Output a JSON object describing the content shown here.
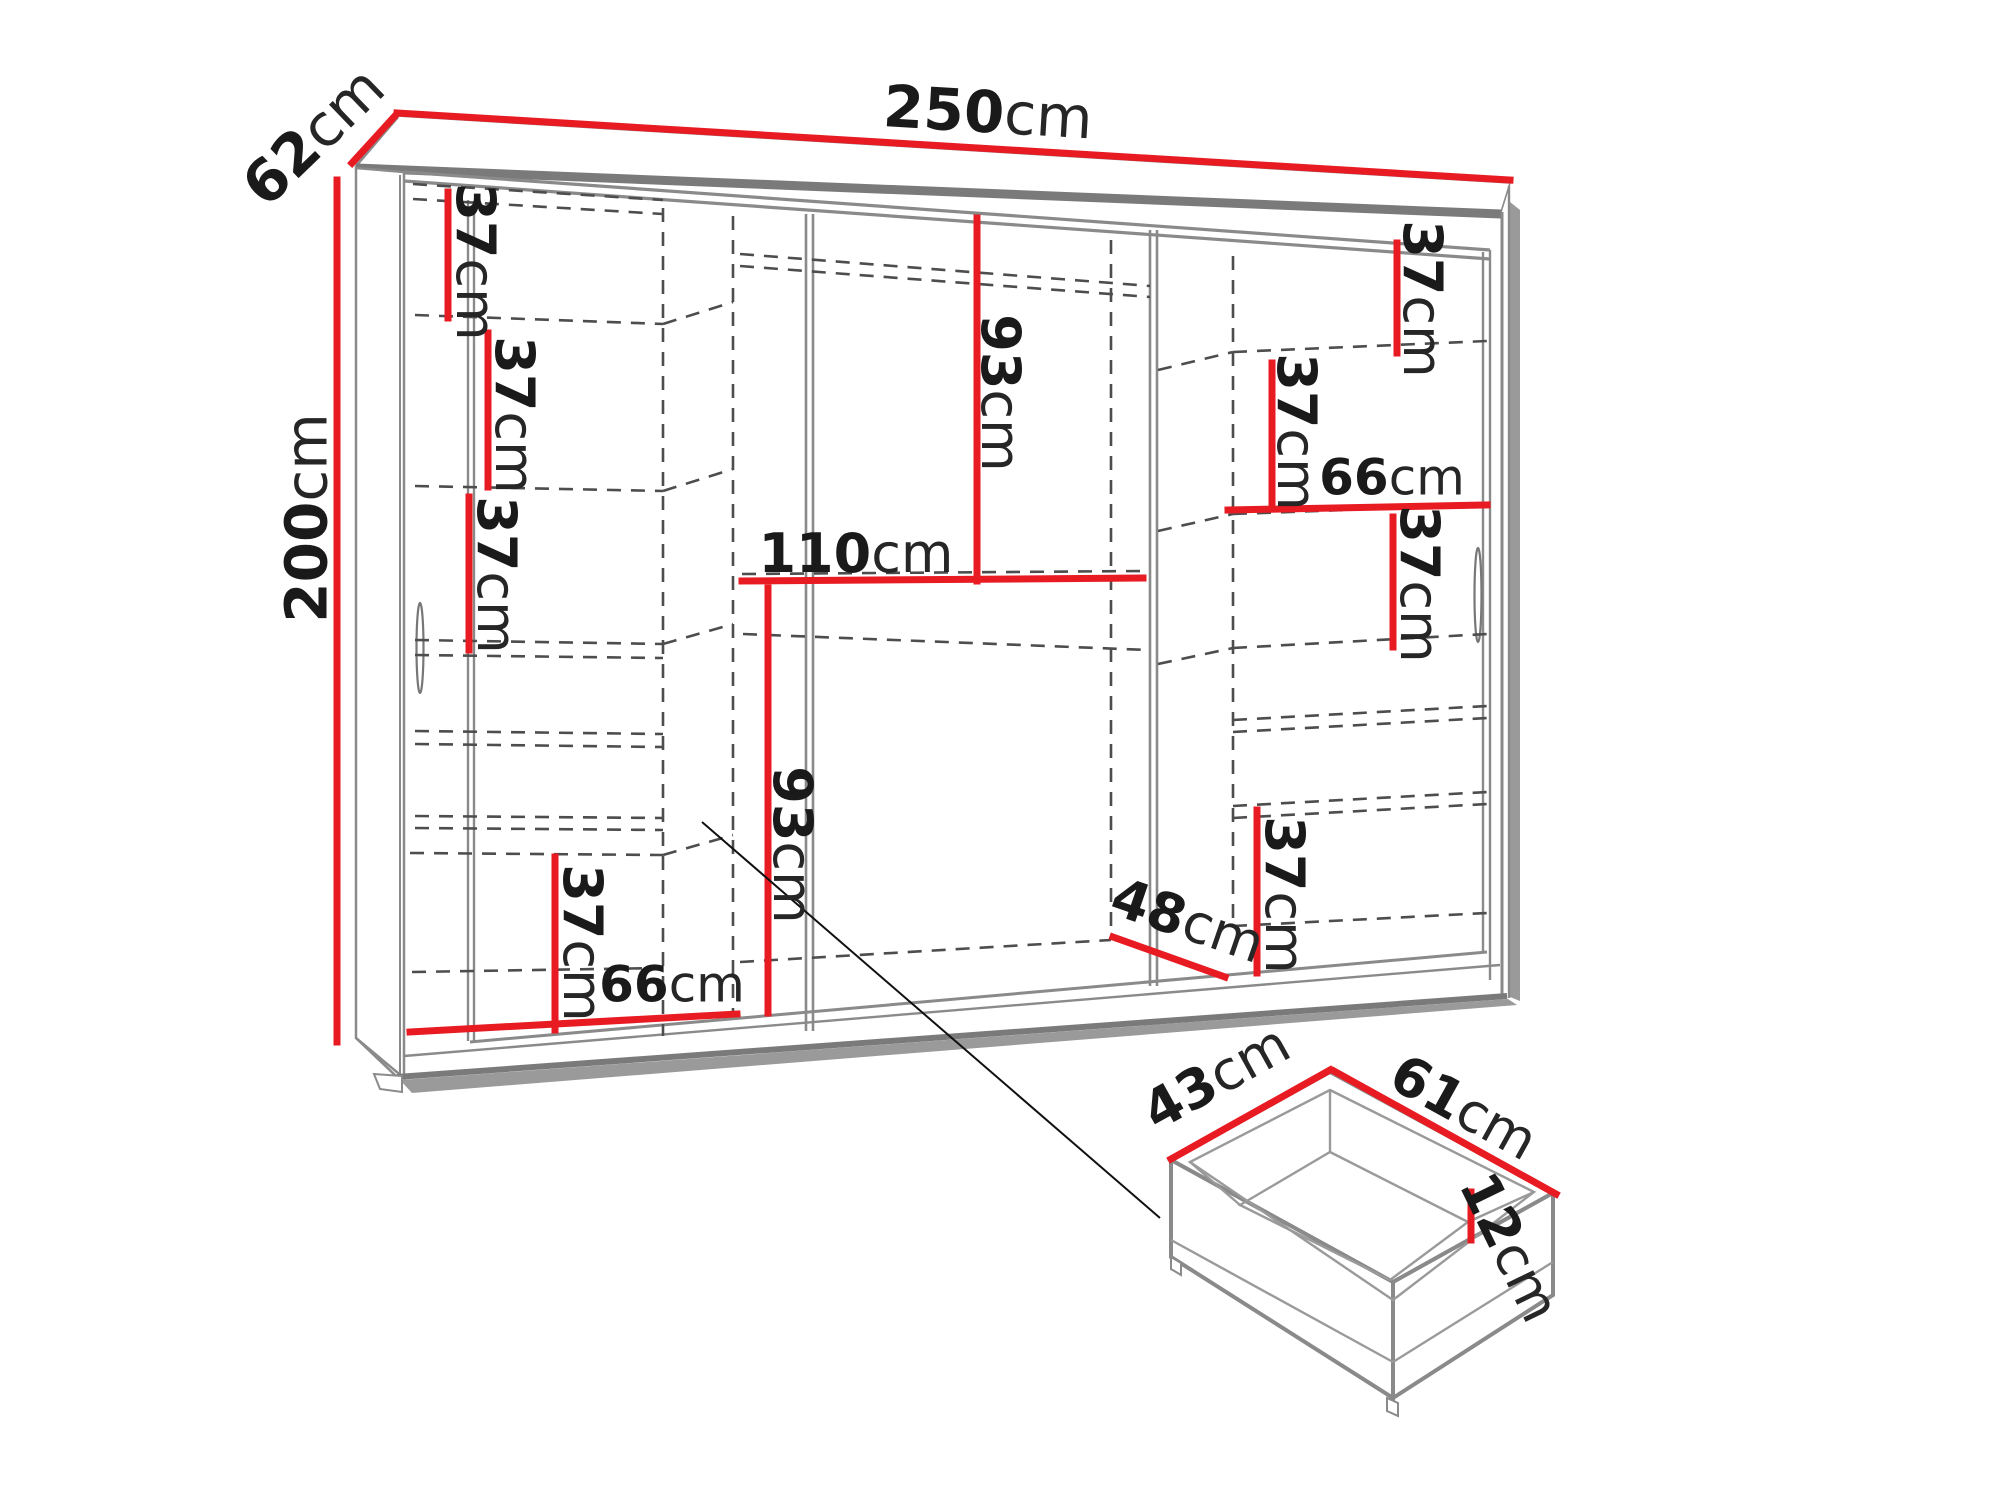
{
  "diagram": {
    "title": "wardrobe-dimension-diagram",
    "description": "Technical dimension drawing of a sliding-door wardrobe interior with detail view of a drawer",
    "colors": {
      "dimension_accent": "#e81b23",
      "outline": "#8a8a8a",
      "hidden_lines": "#4d4d4d",
      "text": "#1a1a1a",
      "background": "#ffffff"
    }
  },
  "labels": {
    "overall_width": {
      "value": "250",
      "unit": "cm"
    },
    "overall_depth": {
      "value": "62",
      "unit": "cm"
    },
    "overall_height": {
      "value": "200",
      "unit": "cm"
    },
    "left_shelf_1": {
      "value": "37",
      "unit": "cm"
    },
    "left_shelf_2": {
      "value": "37",
      "unit": "cm"
    },
    "left_shelf_3": {
      "value": "37",
      "unit": "cm"
    },
    "left_shelf_4": {
      "value": "37",
      "unit": "cm"
    },
    "left_section_width": {
      "value": "66",
      "unit": "cm"
    },
    "middle_upper_height": {
      "value": "93",
      "unit": "cm"
    },
    "middle_shelf_width": {
      "value": "110",
      "unit": "cm"
    },
    "middle_lower_height": {
      "value": "93",
      "unit": "cm"
    },
    "right_shelf_1": {
      "value": "37",
      "unit": "cm"
    },
    "right_shelf_2": {
      "value": "37",
      "unit": "cm"
    },
    "right_section_width": {
      "value": "66",
      "unit": "cm"
    },
    "right_shelf_3": {
      "value": "37",
      "unit": "cm"
    },
    "right_shelf_4": {
      "value": "37",
      "unit": "cm"
    },
    "floor_depth": {
      "value": "48",
      "unit": "cm"
    },
    "drawer_depth": {
      "value": "43",
      "unit": "cm"
    },
    "drawer_width": {
      "value": "61",
      "unit": "cm"
    },
    "drawer_height": {
      "value": "12",
      "unit": "cm"
    }
  },
  "dimensions_cm": {
    "wardrobe": {
      "width": 250,
      "height": 200,
      "depth": 62,
      "shelf_spacing": 37,
      "left_section_width": 66,
      "right_section_width": 66,
      "upper_hanging_height": 93,
      "lower_section_height": 93,
      "middle_shelf_width": 110,
      "usable_floor_depth": 48
    },
    "drawer": {
      "inner_depth": 43,
      "inner_width": 61,
      "height": 12
    }
  }
}
